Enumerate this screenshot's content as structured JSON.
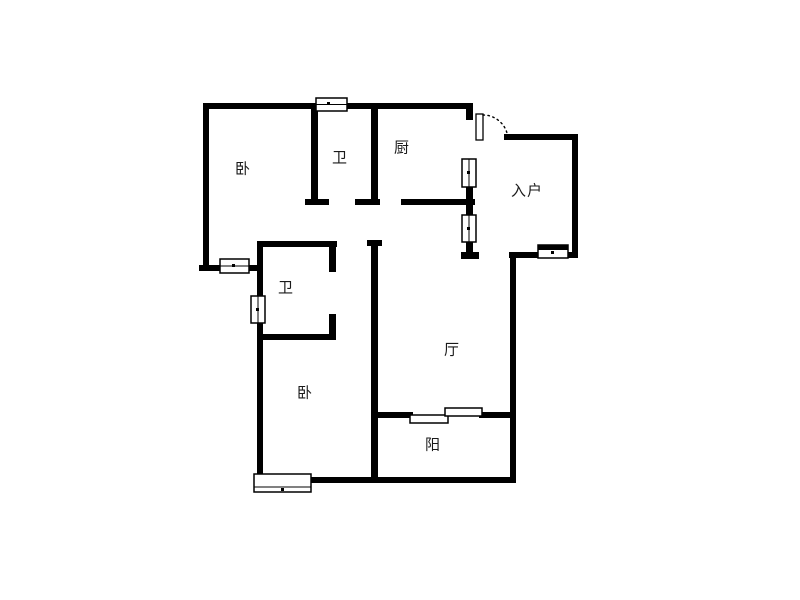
{
  "diagram_type": "apartment-floor-plan",
  "rooms": [
    {
      "id": "bedroom-top-left",
      "label": "卧"
    },
    {
      "id": "bathroom-top",
      "label": "卫"
    },
    {
      "id": "kitchen",
      "label": "厨"
    },
    {
      "id": "entry-hall",
      "label": "入户"
    },
    {
      "id": "bathroom-middle",
      "label": "卫"
    },
    {
      "id": "bedroom-bottom",
      "label": "卧"
    },
    {
      "id": "living-room",
      "label": "厅"
    },
    {
      "id": "balcony",
      "label": "阳"
    }
  ],
  "colors": {
    "wall": "#000000",
    "background": "#ffffff"
  }
}
